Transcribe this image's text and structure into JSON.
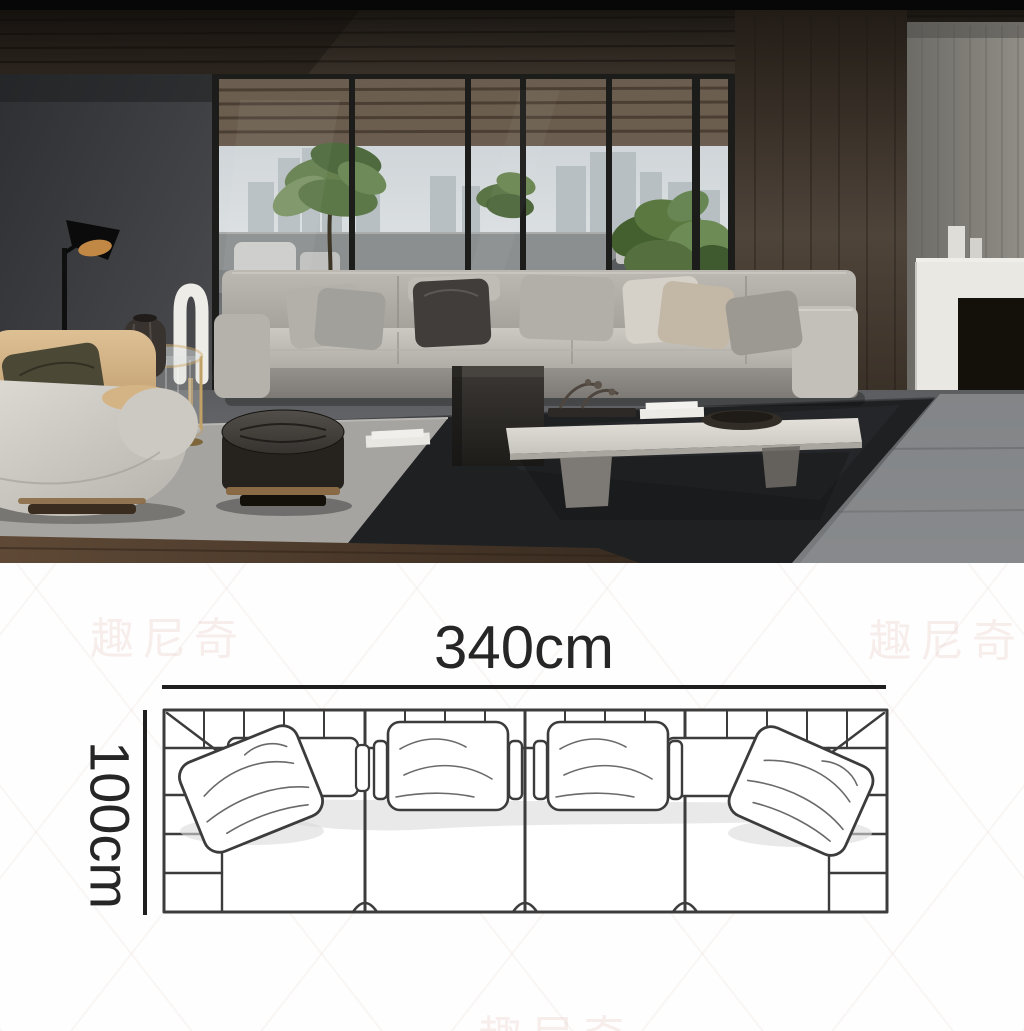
{
  "image": {
    "kind": "furniture product image",
    "scene_description": "Modern living room with a long light-gray fabric sectional sofa by floor-to-ceiling windows, cream swivel armchair, black floor lamp, round dark ottoman, glass side table, white coffee table and fireplace wall"
  },
  "scene_colors": {
    "sofa_fabric": "#b8b5af",
    "left_wall": "#3f4043",
    "wood_wall": "#40362c",
    "panel_wall": "#807d76",
    "black_rug": "#1e2022",
    "light_carpet": "#a6a4a0",
    "accent_gold": "#8a6a44",
    "plant_green": "#5d7848"
  },
  "diagram": {
    "type": "sofa top-view dimension drawing",
    "width_label": "340cm",
    "depth_label": "100cm",
    "line_color": "#2a2a2a",
    "seat_sections": "4"
  },
  "watermark": {
    "text": "趣尼奇",
    "color": "#c98878"
  }
}
